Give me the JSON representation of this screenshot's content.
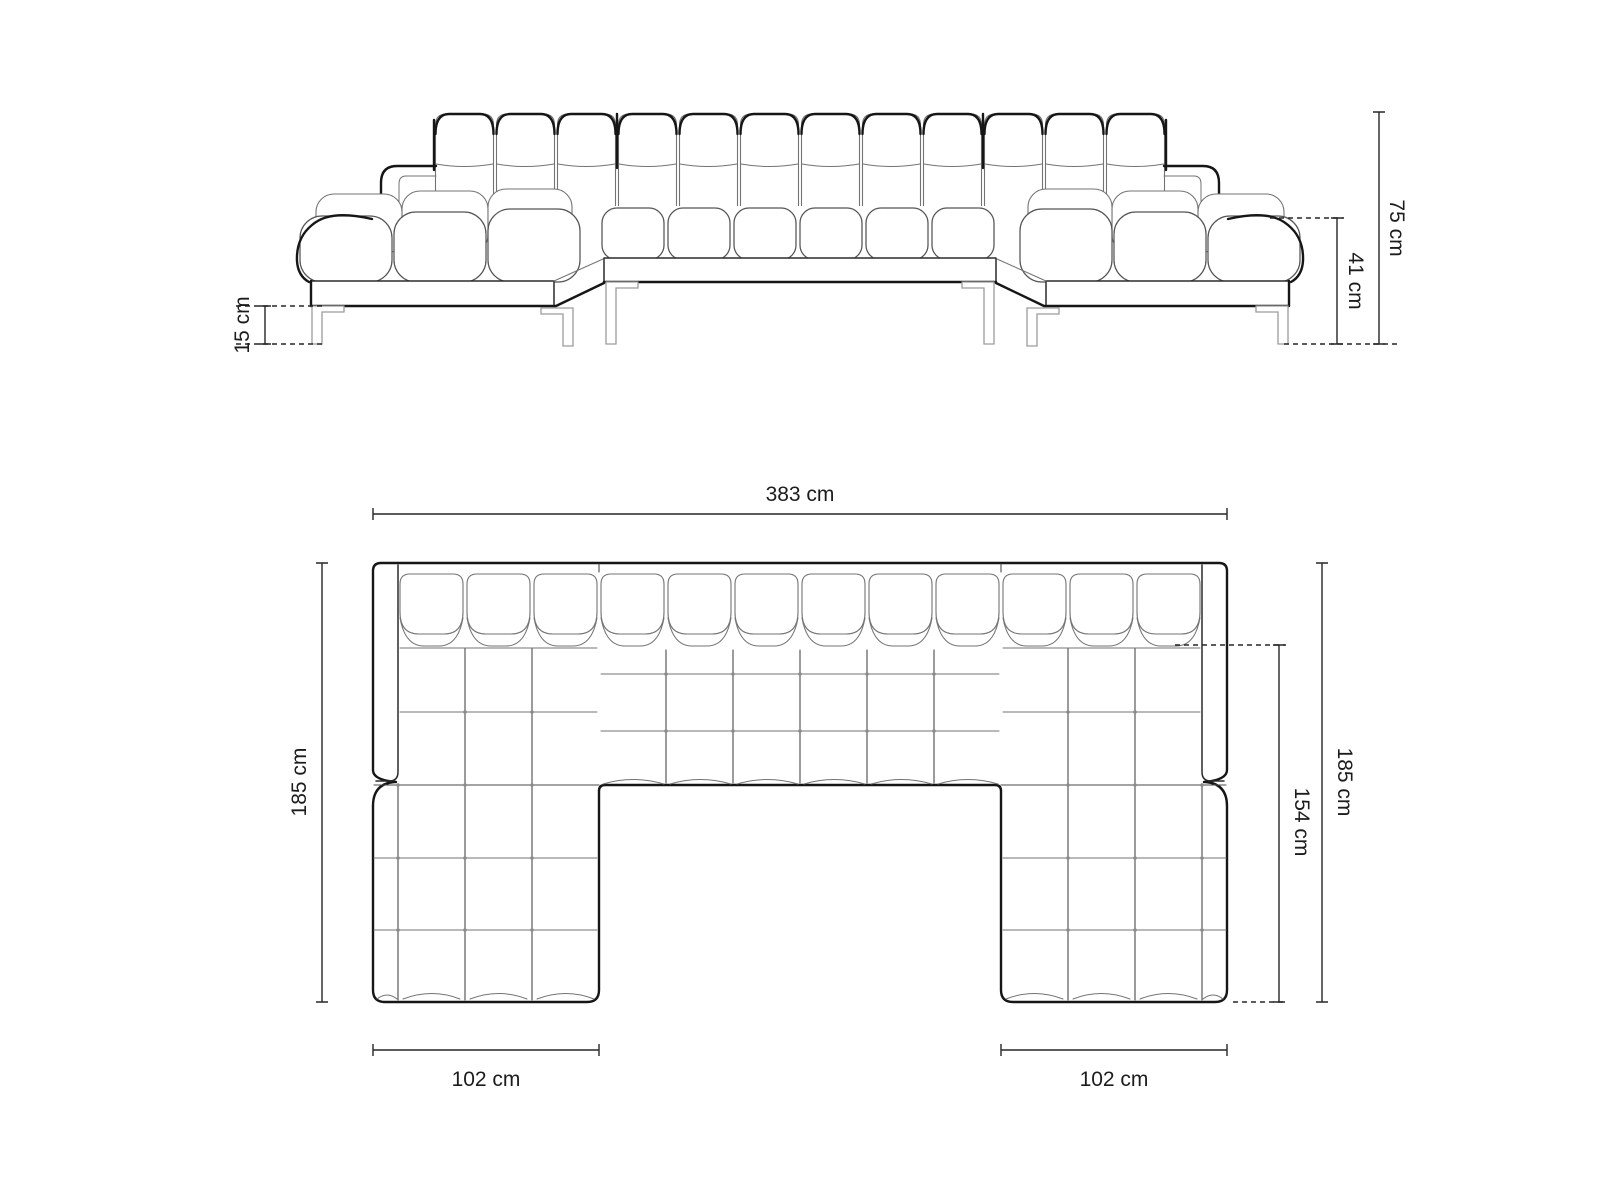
{
  "diagram": {
    "type": "furniture-dimension-drawing",
    "subject": "u-shaped-tufted-sectional-sofa",
    "unit": "cm",
    "views": [
      {
        "id": "front-elevation",
        "dimensions": [
          {
            "id": "total-height",
            "label": "75 cm",
            "value": 75,
            "unit": "cm"
          },
          {
            "id": "arm-height",
            "label": "41 cm",
            "value": 41,
            "unit": "cm"
          },
          {
            "id": "leg-height",
            "label": "15 cm",
            "value": 15,
            "unit": "cm"
          }
        ]
      },
      {
        "id": "top-plan",
        "dimensions": [
          {
            "id": "total-width",
            "label": "383 cm",
            "value": 383,
            "unit": "cm"
          },
          {
            "id": "depth-left",
            "label": "185 cm",
            "value": 185,
            "unit": "cm"
          },
          {
            "id": "depth-right",
            "label": "185 cm",
            "value": 185,
            "unit": "cm"
          },
          {
            "id": "chaise-inner-depth",
            "label": "154 cm",
            "value": 154,
            "unit": "cm"
          },
          {
            "id": "chaise-width-left",
            "label": "102 cm",
            "value": 102,
            "unit": "cm"
          },
          {
            "id": "chaise-width-right",
            "label": "102 cm",
            "value": 102,
            "unit": "cm"
          }
        ]
      }
    ],
    "style": {
      "outline": "#161616",
      "tuft": "#737373",
      "leg": "#9c9c9c",
      "dim": "#262626",
      "label": "#1c1c1c",
      "bg": "#ffffff"
    }
  }
}
